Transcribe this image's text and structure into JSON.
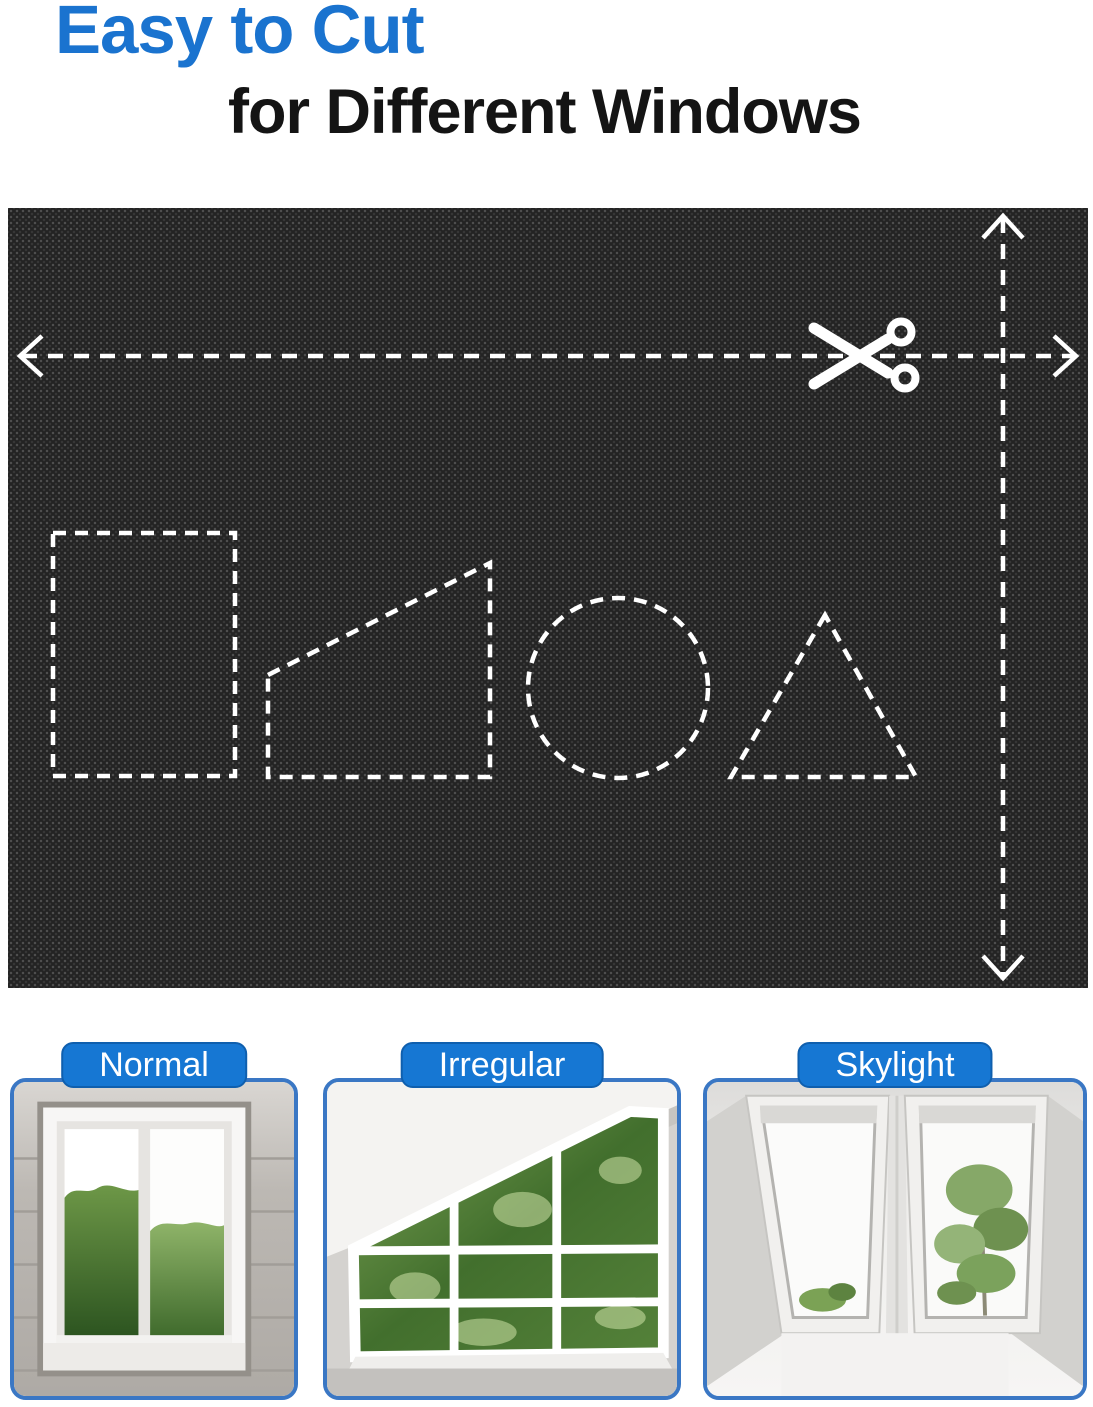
{
  "header": {
    "title_line1": "Easy to Cut",
    "title_line2": "for Different Windows"
  },
  "colors": {
    "title_blue": "#1a73cf",
    "title_black": "#141414",
    "badge_blue": "#1677d3",
    "badge_text": "#ffffff",
    "card_border_blue": "#3a77c4",
    "fabric_base": "#232323",
    "cut_line_white": "#ffffff"
  },
  "fabric_panel": {
    "icons": [
      "scissors-icon",
      "arrow-left-icon",
      "arrow-right-icon",
      "arrow-up-icon",
      "arrow-down-icon"
    ],
    "cut_shapes": [
      "rectangle",
      "trapezoid",
      "circle",
      "triangle"
    ]
  },
  "window_types": [
    {
      "label": "Normal"
    },
    {
      "label": "Irregular"
    },
    {
      "label": "Skylight"
    }
  ]
}
